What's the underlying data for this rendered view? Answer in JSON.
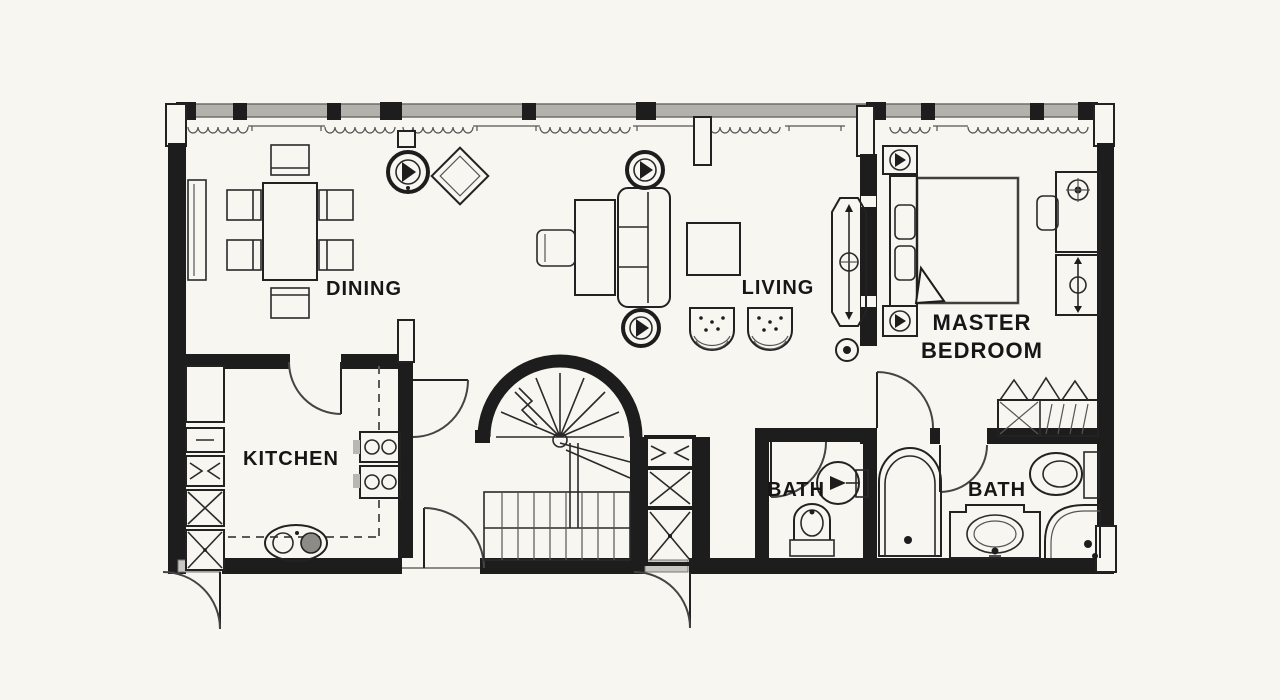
{
  "colors": {
    "background": "#f8f6f0",
    "ink": "#1d1d1d",
    "band": "#b3b1ac",
    "threshold": "#c9c7c2"
  },
  "rooms": {
    "dining": {
      "label": "DINING",
      "fixtures": [
        "dining-table",
        "dining-chairs-x6",
        "sideboard",
        "ceiling-light",
        "side-table"
      ]
    },
    "living": {
      "label": "LIVING",
      "fixtures": [
        "sofa",
        "coffee-table",
        "desk",
        "desk-chair",
        "tub-chair",
        "tub-chair",
        "ceiling-light",
        "ceiling-light",
        "wall-light",
        "media-console"
      ]
    },
    "master_bedroom": {
      "line1": "MASTER",
      "line2": "BEDROOM",
      "fixtures": [
        "double-bed",
        "nightstand",
        "nightstand",
        "desk",
        "desk-chair",
        "dresser",
        "wardrobe"
      ]
    },
    "kitchen": {
      "label": "KITCHEN",
      "fixtures": [
        "refrigerator",
        "storage-cells",
        "cooktop",
        "double-sink",
        "counter"
      ]
    },
    "bath_small": {
      "label": "BATH",
      "fixtures": [
        "toilet",
        "pedestal-sink"
      ]
    },
    "bath_master": {
      "label": "BATH",
      "fixtures": [
        "bathtub",
        "vanity-sink",
        "toilet",
        "shower"
      ]
    },
    "stairs": {
      "fixtures": [
        "winder-stair",
        "straight-flight",
        "closet-cells"
      ]
    }
  }
}
